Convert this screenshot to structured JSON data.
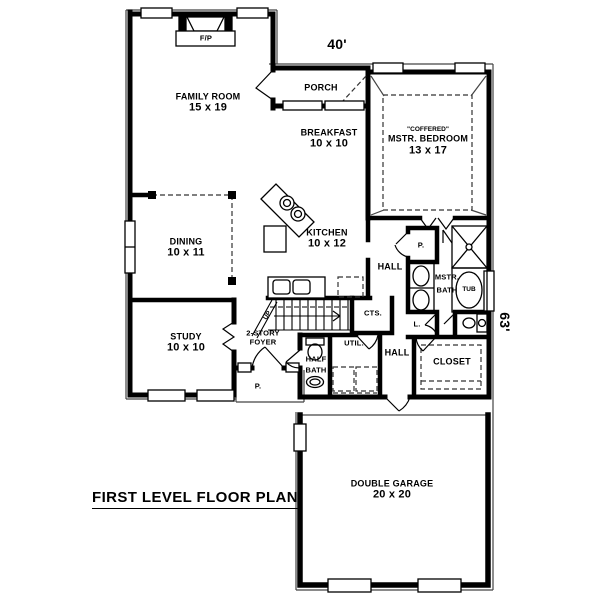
{
  "plan": {
    "title": "FIRST LEVEL FLOOR PLAN",
    "width_dim": "40'",
    "depth_dim": "63'"
  },
  "rooms": {
    "family_room": {
      "name": "FAMILY ROOM",
      "size": "15 x 19"
    },
    "porch": {
      "name": "PORCH"
    },
    "master_bedroom": {
      "ceiling": "\"COFFERED\"",
      "name": "MSTR. BEDROOM",
      "size": "13 x 17"
    },
    "breakfast": {
      "name": "BREAKFAST",
      "size": "10 x 10"
    },
    "kitchen": {
      "name": "KITCHEN",
      "size": "10 x 12"
    },
    "dining": {
      "name": "DINING",
      "size": "10 x 11"
    },
    "study": {
      "name": "STUDY",
      "size": "10 x 10"
    },
    "foyer": {
      "line1": "2-STORY",
      "line2": "FOYER"
    },
    "hall_upper": {
      "name": "HALL"
    },
    "hall_lower": {
      "name": "HALL"
    },
    "master_bath": {
      "line1": "MSTR.",
      "line2": "BATH"
    },
    "half_bath": {
      "line1": "HALF",
      "line2": "BATH"
    },
    "utility": {
      "name": "UTIL."
    },
    "closet": {
      "name": "CLOSET"
    },
    "garage": {
      "name": "DOUBLE GARAGE",
      "size": "20 x 20"
    }
  },
  "fixtures": {
    "fireplace": "F/P",
    "tub": "TUB",
    "stairs_up": "UP",
    "stairs_closet": "CTS.",
    "pantry": "P.",
    "linen": "L.",
    "entry_stoop": "P."
  }
}
